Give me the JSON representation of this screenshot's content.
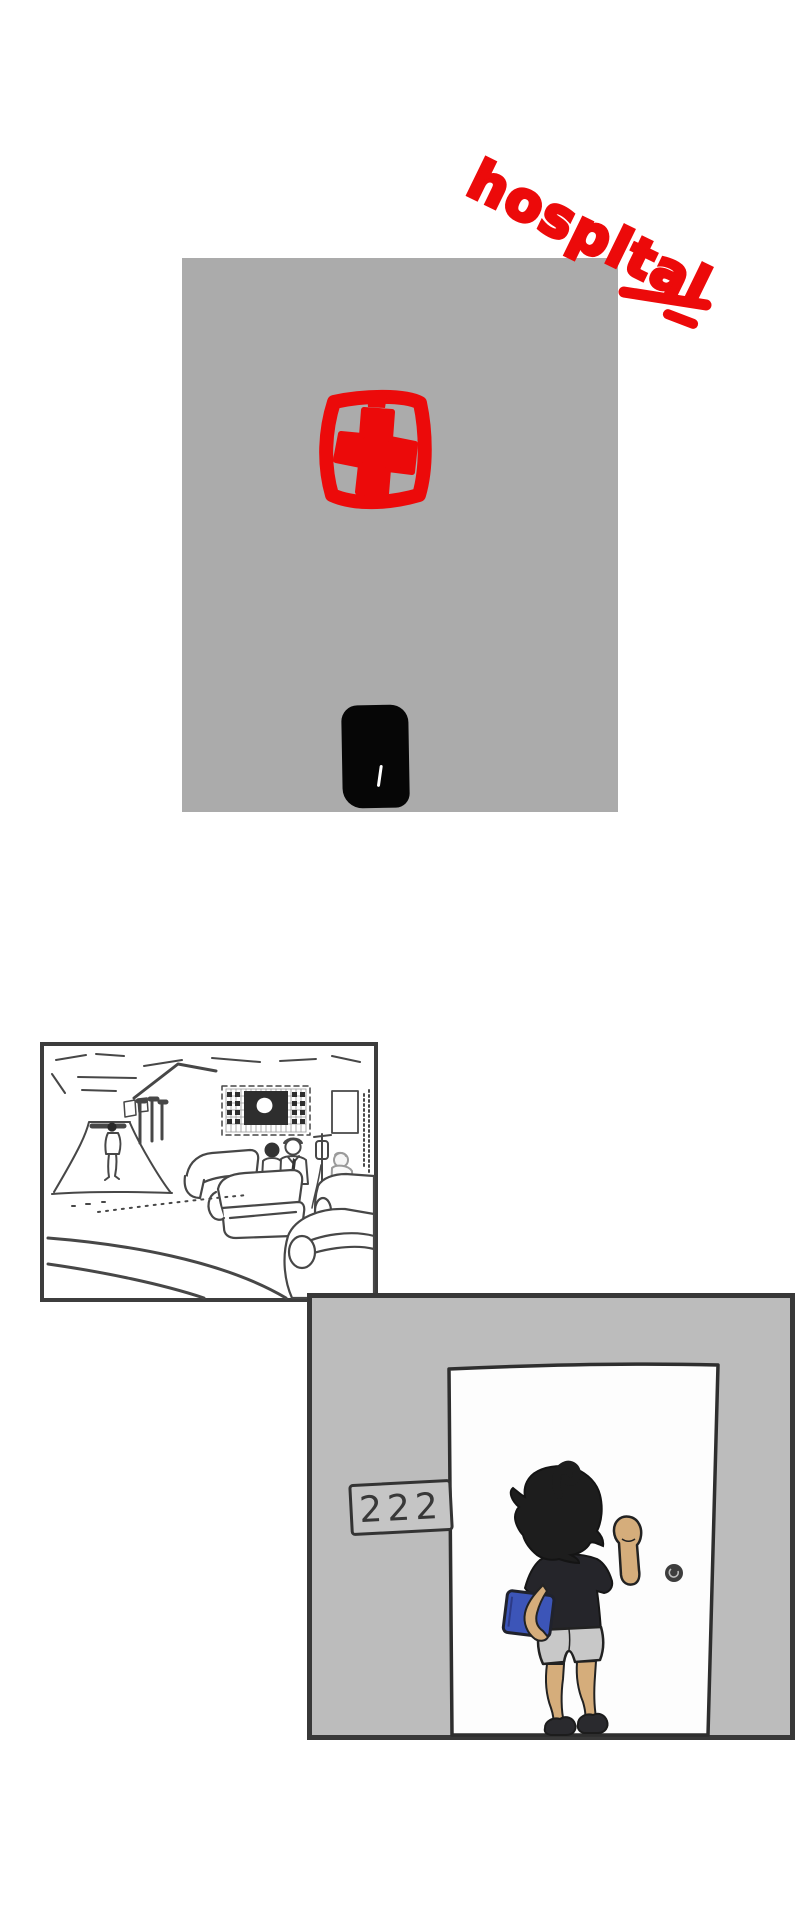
{
  "panel1": {
    "handwritten_label": "hospital",
    "label_color": "#ec0a0a",
    "building_color": "#ababab",
    "entrance_door_color": "#060606",
    "sign_icon": "red-cross-hospital-sign-icon"
  },
  "panel2": {
    "scene_icon": "waiting-room-line-art-sketch"
  },
  "panel3": {
    "room_number": "222",
    "wall_color": "#bcbcbc",
    "door_color": "#fdfdfd",
    "book_color": "#3c55b8",
    "skin_color": "#d5ad7b",
    "shorts_color": "#c8c8c8",
    "hair_color": "#1d1d1d",
    "knob_icon": "round-door-knob-icon"
  },
  "colors": {
    "panel_border": "#3a3a3a",
    "sketch_stroke": "#474747",
    "accent_red": "#ec0a0a"
  }
}
